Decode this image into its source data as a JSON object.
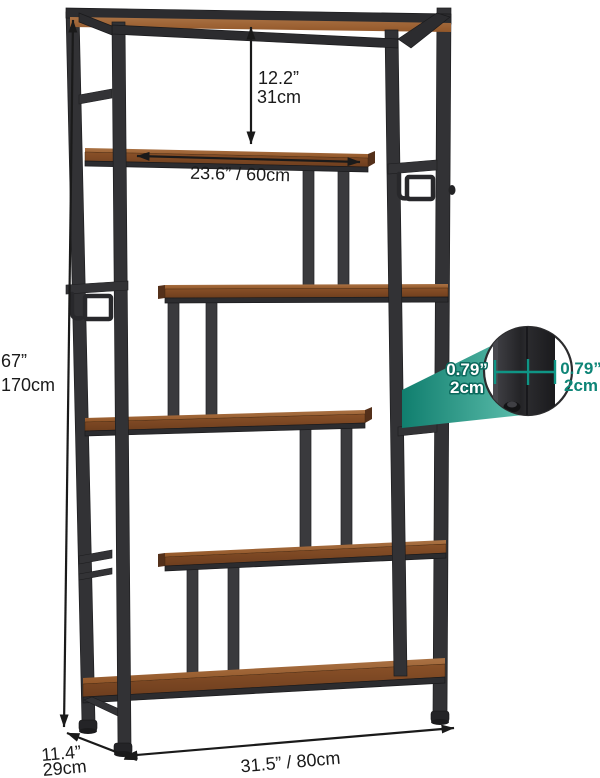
{
  "measurements": {
    "inner_height": {
      "imperial": "12.2”",
      "metric": "31cm"
    },
    "shelf_length": {
      "combined": "23.6” / 60cm"
    },
    "overall_height": {
      "imperial": "67”",
      "metric": "170cm"
    },
    "tube_width_left": {
      "imperial": "0.79”",
      "metric": "2cm"
    },
    "tube_width_right": {
      "imperial": "0.79”",
      "metric": "2cm"
    },
    "overall_width": {
      "combined": "31.5” / 80cm"
    },
    "overall_depth": {
      "imperial": "11.4”",
      "metric": "29cm"
    }
  },
  "colors": {
    "frame": "#323235",
    "wood_top": "#a06a3c",
    "wood_front": "#7c4a26",
    "accent_teal": "#0f9585",
    "dimension_text": "#1a1a1a",
    "background": "#ffffff"
  }
}
